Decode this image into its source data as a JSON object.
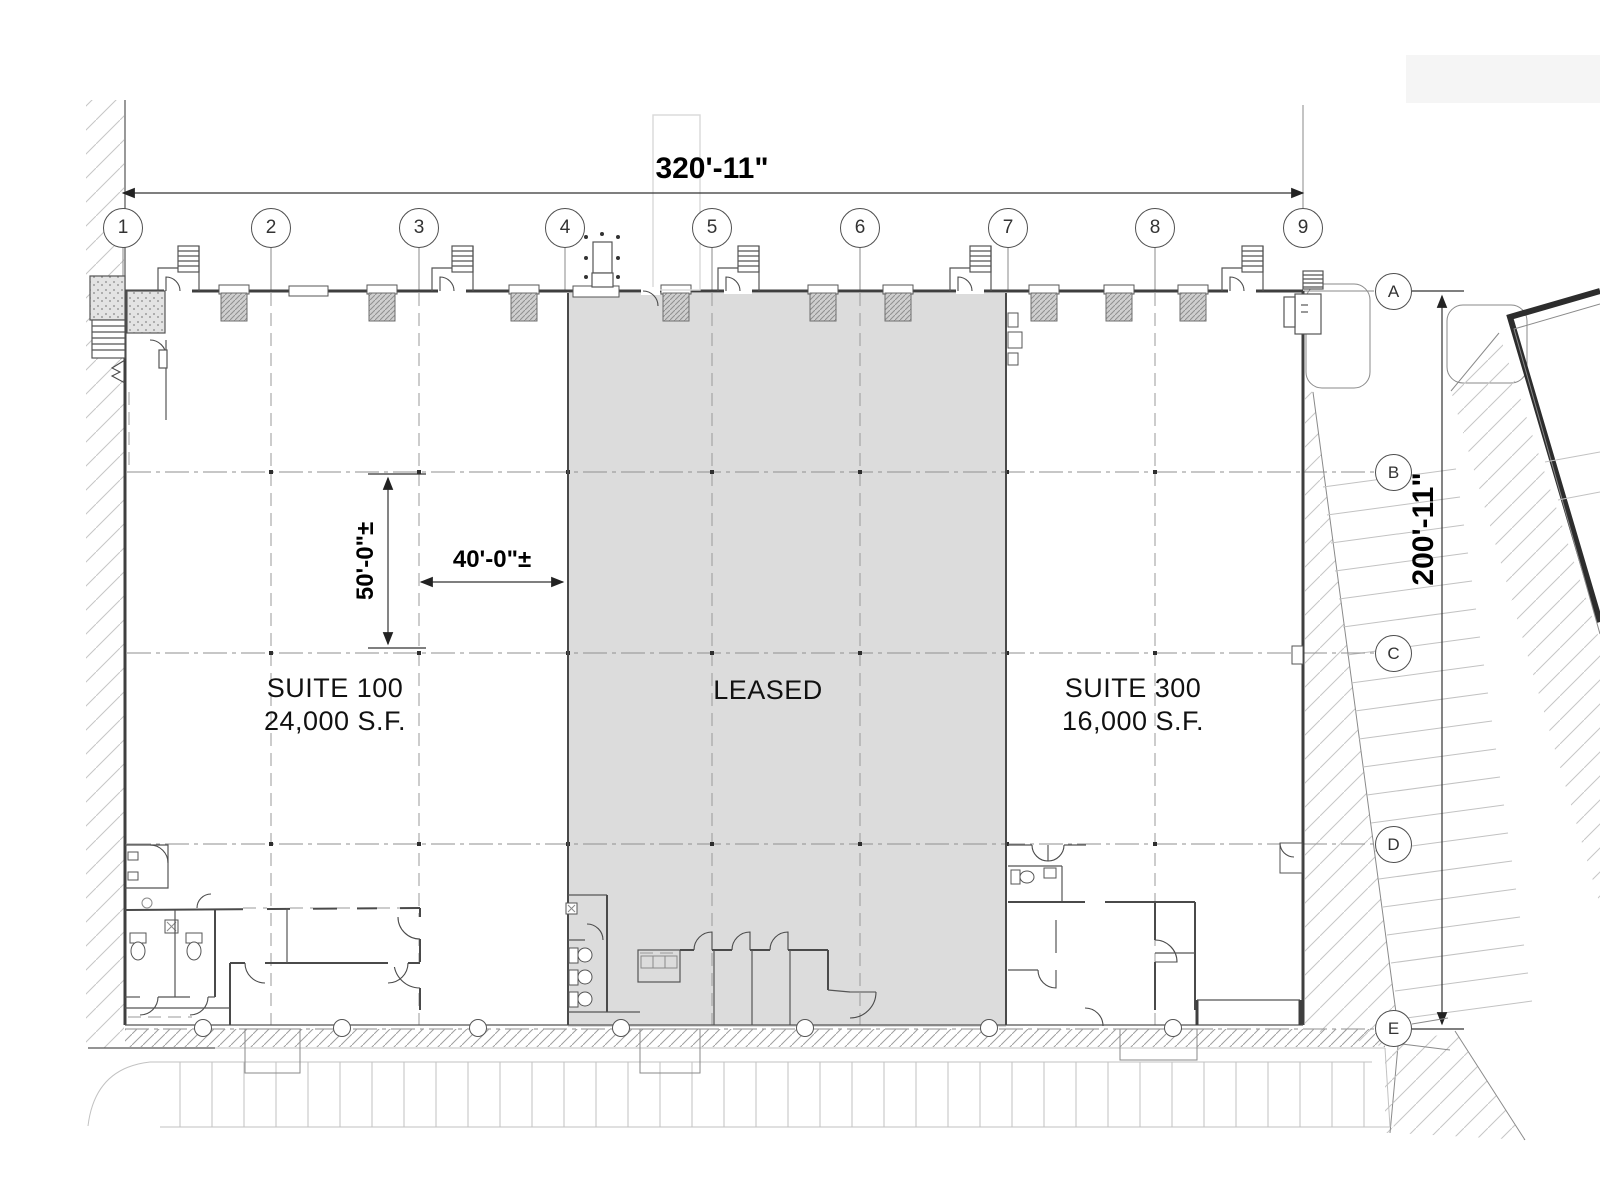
{
  "drawing": {
    "title": "floor-plan",
    "suites": [
      {
        "name": "SUITE 100",
        "area": "24,000 S.F."
      },
      {
        "name": "LEASED",
        "area": ""
      },
      {
        "name": "SUITE 300",
        "area": "16,000 S.F."
      }
    ],
    "dimensions": {
      "overall_width": "320'-11\"",
      "overall_depth": "200'-11\"",
      "bay_depth": "50'-0\"±",
      "bay_width": "40'-0\"±"
    },
    "grid": {
      "columns": [
        "1",
        "2",
        "3",
        "4",
        "5",
        "6",
        "7",
        "8",
        "9"
      ],
      "rows": [
        "A",
        "B",
        "C",
        "D",
        "E"
      ]
    },
    "colors": {
      "leased_fill": "#dcdcdc",
      "line": "#3f3f3f"
    }
  }
}
